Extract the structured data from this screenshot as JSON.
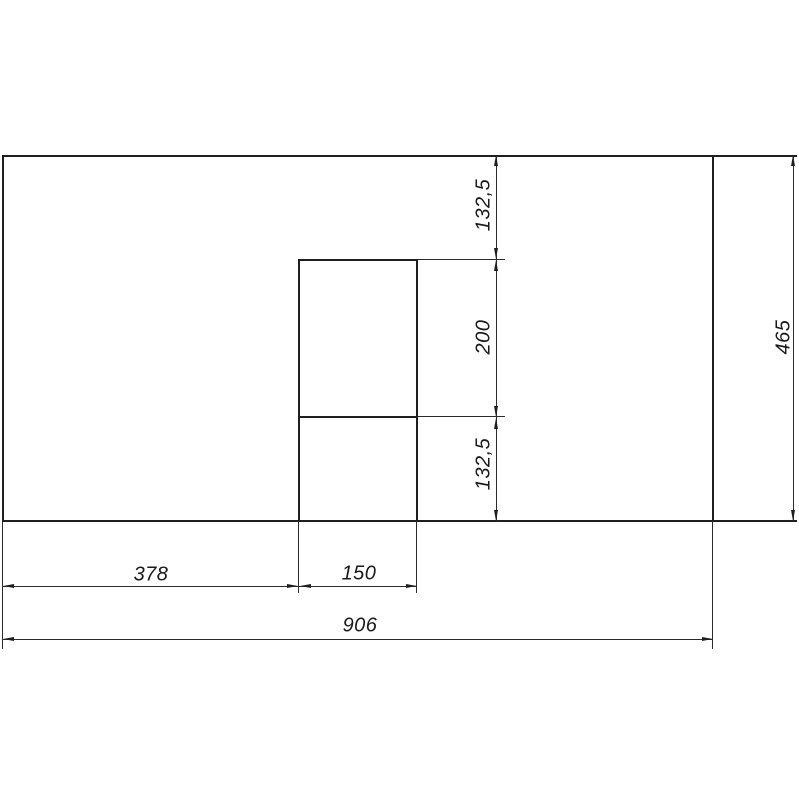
{
  "drawing": {
    "background": "#ffffff",
    "line_color": "#1f1f1f",
    "type": "panel-with-cutout-dimension-drawing",
    "panel": {
      "overall_width": "906",
      "overall_height": "465"
    },
    "cutout": {
      "width": "150",
      "height": "200",
      "offset_from_left": "378",
      "offset_from_top": "132,5",
      "offset_from_bottom": "132,5"
    },
    "dimensions": {
      "seg_top": "132,5",
      "seg_mid": "200",
      "seg_bottom": "132,5",
      "height_total": "465",
      "offset_left": "378",
      "cutout_width": "150",
      "width_total": "906"
    }
  }
}
